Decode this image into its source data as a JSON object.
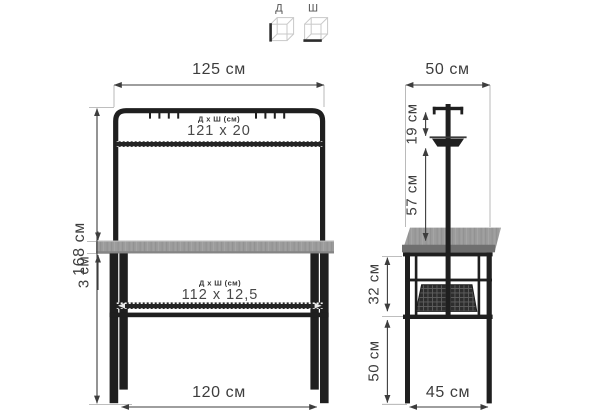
{
  "legend": {
    "depth_icon_label": "Д",
    "width_icon_label": "Ш"
  },
  "front_view": {
    "top_width": "125 см",
    "height": "168 см",
    "top_shelf": {
      "label": "Д x Ш (см)",
      "value": "121 x 20"
    },
    "desktop_thickness": "3 см",
    "lower_shelf": {
      "label": "Д x Ш (см)",
      "value": "112 x 12,5"
    },
    "bottom_width": "120 см"
  },
  "side_view": {
    "top_depth": "50 см",
    "organizer_gap": "19 см",
    "organizer_height": "57 см",
    "desk_to_shelf": "32 см",
    "shelf_to_floor": "50 см",
    "bottom_depth": "45 см"
  },
  "colors": {
    "frame": "#1f1f1f",
    "desktop": "#9c9c9c",
    "desktop-edge": "#6f6f6f",
    "dimension": "#3d3d3d",
    "extension": "#a9a9a9",
    "wireframe": "#c9c9c9",
    "mesh": "#262626"
  }
}
